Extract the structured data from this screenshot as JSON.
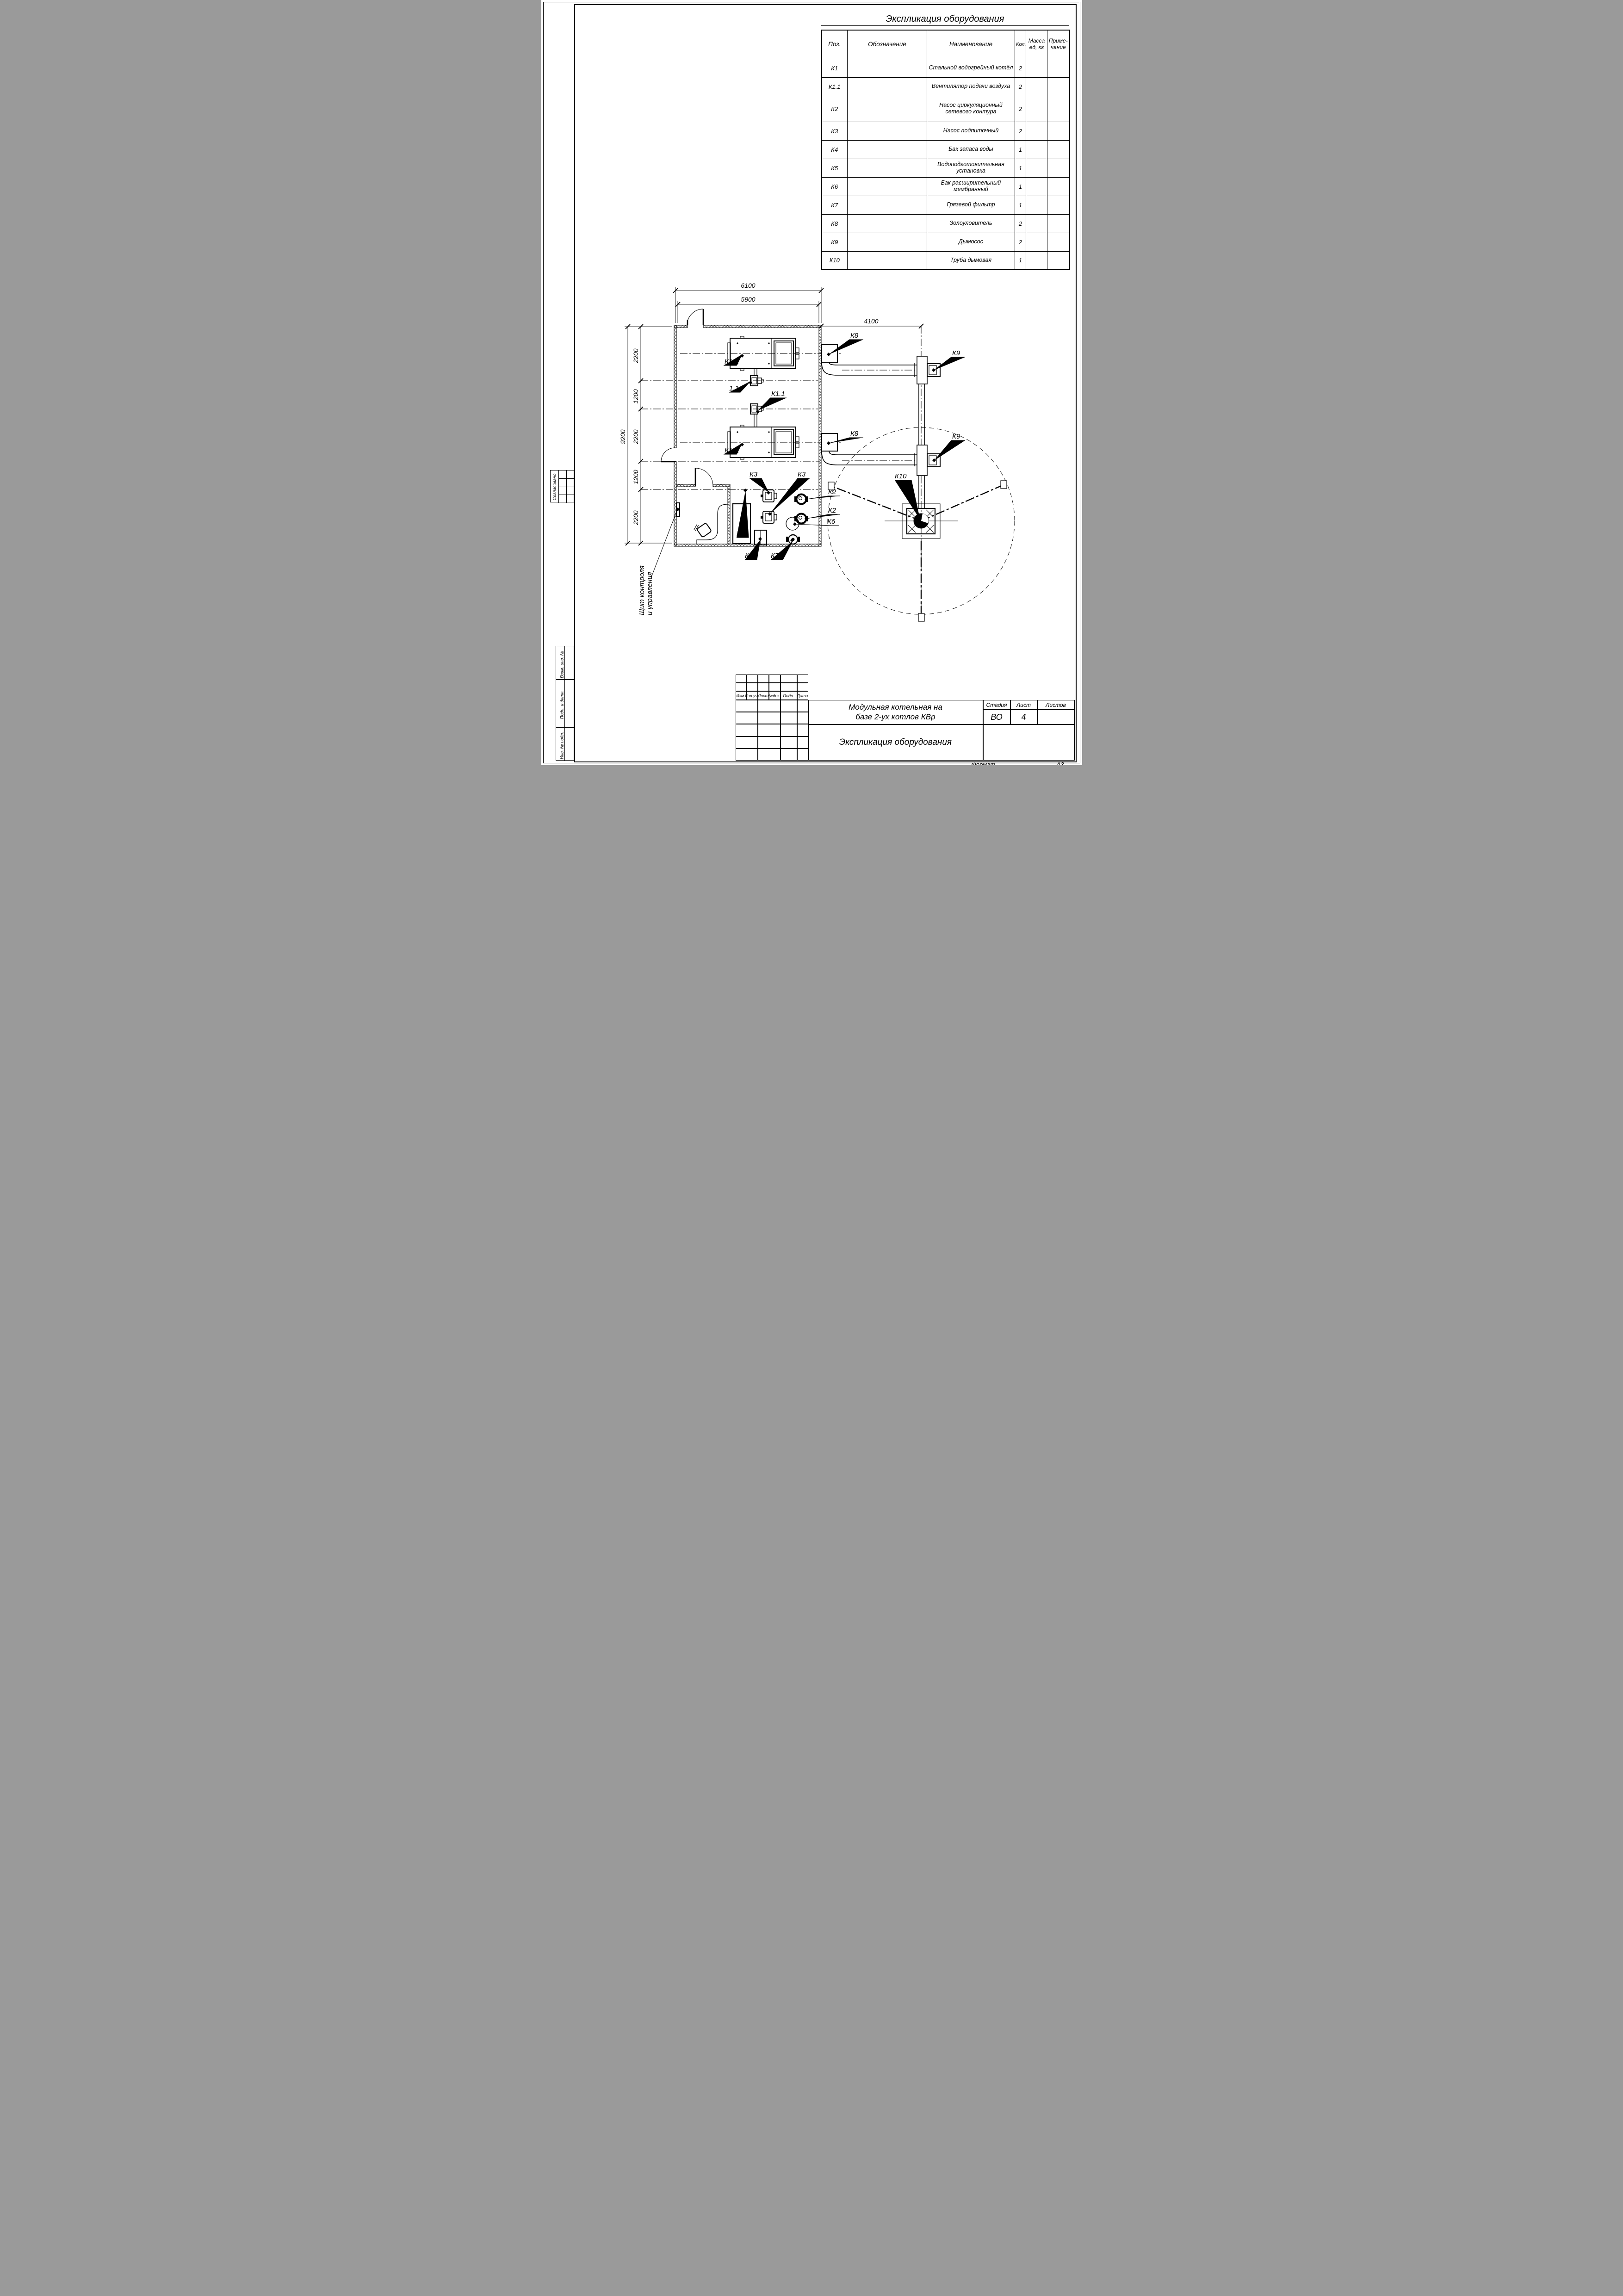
{
  "page": {
    "format_label": "Формат",
    "format_value": "А3"
  },
  "stamps": {
    "soglasovano": "Согласовано",
    "vzam": "Взам. инв. №",
    "podp_data": "Подп. и дата",
    "inv_podl": "Инв. № подл."
  },
  "equipment_table": {
    "title": "Экспликация оборудования",
    "headers": {
      "pos": "Поз.",
      "designation": "Обозначение",
      "name": "Наименование",
      "qty": "Кол.",
      "mass_l1": "Масса",
      "mass_l2": "ед, кг",
      "note_l1": "Приме-",
      "note_l2": "чание"
    },
    "rows": [
      {
        "pos": "К1",
        "name": "Стальной водогрейный котёл",
        "qty": "2"
      },
      {
        "pos": "К1.1",
        "name": "Вентилятор подачи воздуха",
        "qty": "2"
      },
      {
        "pos": "К2",
        "name": "Насос циркуляционный сетевого контура",
        "qty": "2"
      },
      {
        "pos": "К3",
        "name": "Насос подпиточный",
        "qty": "2"
      },
      {
        "pos": "К4",
        "name": "Бак запаса воды",
        "qty": "1"
      },
      {
        "pos": "К5",
        "name": "Водоподготовительная установка",
        "qty": "1"
      },
      {
        "pos": "К6",
        "name": "Бак расширительный мембранный",
        "qty": "1"
      },
      {
        "pos": "К7",
        "name": "Грязевой фильтр",
        "qty": "1"
      },
      {
        "pos": "К8",
        "name": "Золоуловитель",
        "qty": "2"
      },
      {
        "pos": "К9",
        "name": "Дымосос",
        "qty": "2"
      },
      {
        "pos": "К10",
        "name": "Труба дымовая",
        "qty": "1"
      }
    ]
  },
  "title_block": {
    "project_l1": "Модульная котельная на",
    "project_l2": "базе 2-ух котлов КВр",
    "doc_title": "Экспликация оборудования",
    "stage_label": "Стадия",
    "sheet_label": "Лист",
    "sheets_label": "Листов",
    "stage": "ВО",
    "sheet": "4",
    "sheets": ""
  },
  "revision": {
    "izm": "Изм.",
    "koluch": "Кол.уч.",
    "list": "Лист",
    "ndok": "№док.",
    "podp": "Подп.",
    "data": "Дата"
  },
  "plan": {
    "dims": {
      "top_outer": "6100",
      "top_inner": "5900",
      "right": "4100",
      "total": "9200",
      "seg1": "2200",
      "seg2": "1200",
      "seg3": "2200",
      "seg4": "1200",
      "seg5": "2200"
    },
    "labels": {
      "k1": "К1",
      "k1_1": "К1.1",
      "one_one": "1.1",
      "k2": "К2",
      "k3": "К3",
      "k4": "К4",
      "k5": "К5",
      "k6": "К6",
      "k7": "К7",
      "k8": "К8",
      "k9": "К9",
      "k10": "К10"
    },
    "note_l1": "Щит контроля",
    "note_l2": "и управления"
  }
}
